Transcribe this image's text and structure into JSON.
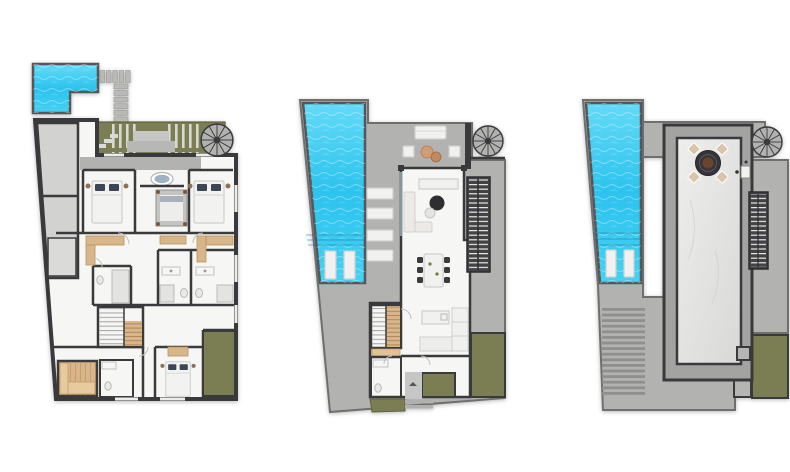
{
  "document": {
    "kind": "architectural-floor-plans",
    "plan_count": 3
  },
  "plans": [
    {
      "id": "lower-level",
      "features": [
        "l-shaped-plunge-pool",
        "stepping-stone-path",
        "roof-garden-strip",
        "spiral-staircase",
        "garage-storage",
        "bedroom-1",
        "canopy-bedroom",
        "bedroom-3",
        "bathtub",
        "bathrooms",
        "wardrobes",
        "u-staircase",
        "sauna",
        "bedroom-4",
        "garden-patch"
      ]
    },
    {
      "id": "main-level",
      "features": [
        "lap-pool",
        "in-pool-loungers",
        "sun-loungers",
        "outdoor-lounge",
        "spiral-staircase",
        "living-room",
        "l-sofa",
        "coffee-tables",
        "tv-console",
        "dining-table-6",
        "kitchen-island",
        "kitchen-counter",
        "wooden-u-staircase",
        "exterior-dark-stair",
        "guest-bathroom",
        "entrance-path",
        "garden-patches"
      ]
    },
    {
      "id": "roof-level",
      "features": [
        "lap-pool",
        "in-pool-loungers",
        "roof-terrace",
        "fire-pit-lounge",
        "marble-roof-panel",
        "spiral-staircase",
        "exterior-dark-stair",
        "louvered-pergola",
        "skylights",
        "garden-patch"
      ]
    }
  ],
  "colors": {
    "background": "#ffffff",
    "poolWater": "#2cc3ee",
    "poolWaterLight": "#63daf6",
    "poolBorder": "#55565a",
    "deck": "#b2b2b0",
    "deckLight": "#c6c6c4",
    "concrete": "#d2d2d0",
    "wall": "#3a3a3c",
    "wallDark": "#2c2c2e",
    "floor": "#f6f6f4",
    "marbleLight": "#eeeeec",
    "marbleDark": "#d8d8d6",
    "garden": "#7b7e52",
    "wood": "#d8b68a",
    "furnitureWhite": "#f1f1ef",
    "stairDark": "#434345",
    "pillowDark": "#3d4654",
    "pouf": "#cf9e74",
    "tub": "#9db3c4",
    "firePit": "#35353a",
    "fireCenter": "#6e432e"
  }
}
